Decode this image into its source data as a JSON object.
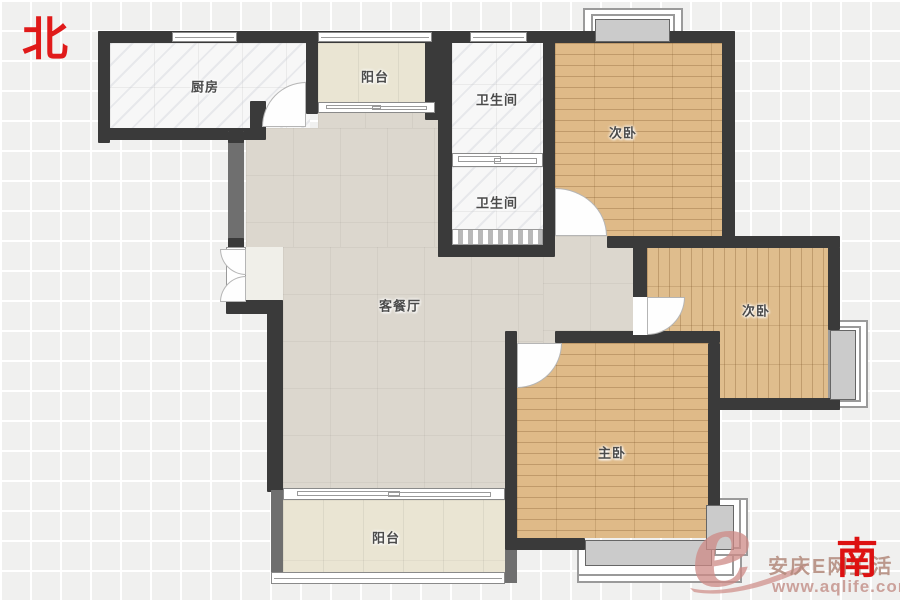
{
  "compass": {
    "north": "北",
    "south": "南"
  },
  "rooms": {
    "kitchen": "厨房",
    "balcony_top": "阳台",
    "bath_top": "卫生间",
    "bath_mid": "卫生间",
    "bedroom_ne": "次卧",
    "bedroom_e": "次卧",
    "living": "客餐厅",
    "master": "主卧",
    "balcony_bottom": "阳台"
  },
  "watermark": {
    "logo_letter": "e",
    "brand_text": "安庆E网生活",
    "site_url": "www.aqlife.com"
  },
  "colors": {
    "compass_red": "#e01a1a",
    "wall_dark": "#3a3a3a",
    "wall_gray": "#6f6f6f",
    "wood_floor": "#dfba88",
    "living_floor": "#dcd7ce",
    "balcony_floor": "#eae5d3",
    "tile_white": "#f7f7f7",
    "watermark_pink": "#cf9a94"
  }
}
